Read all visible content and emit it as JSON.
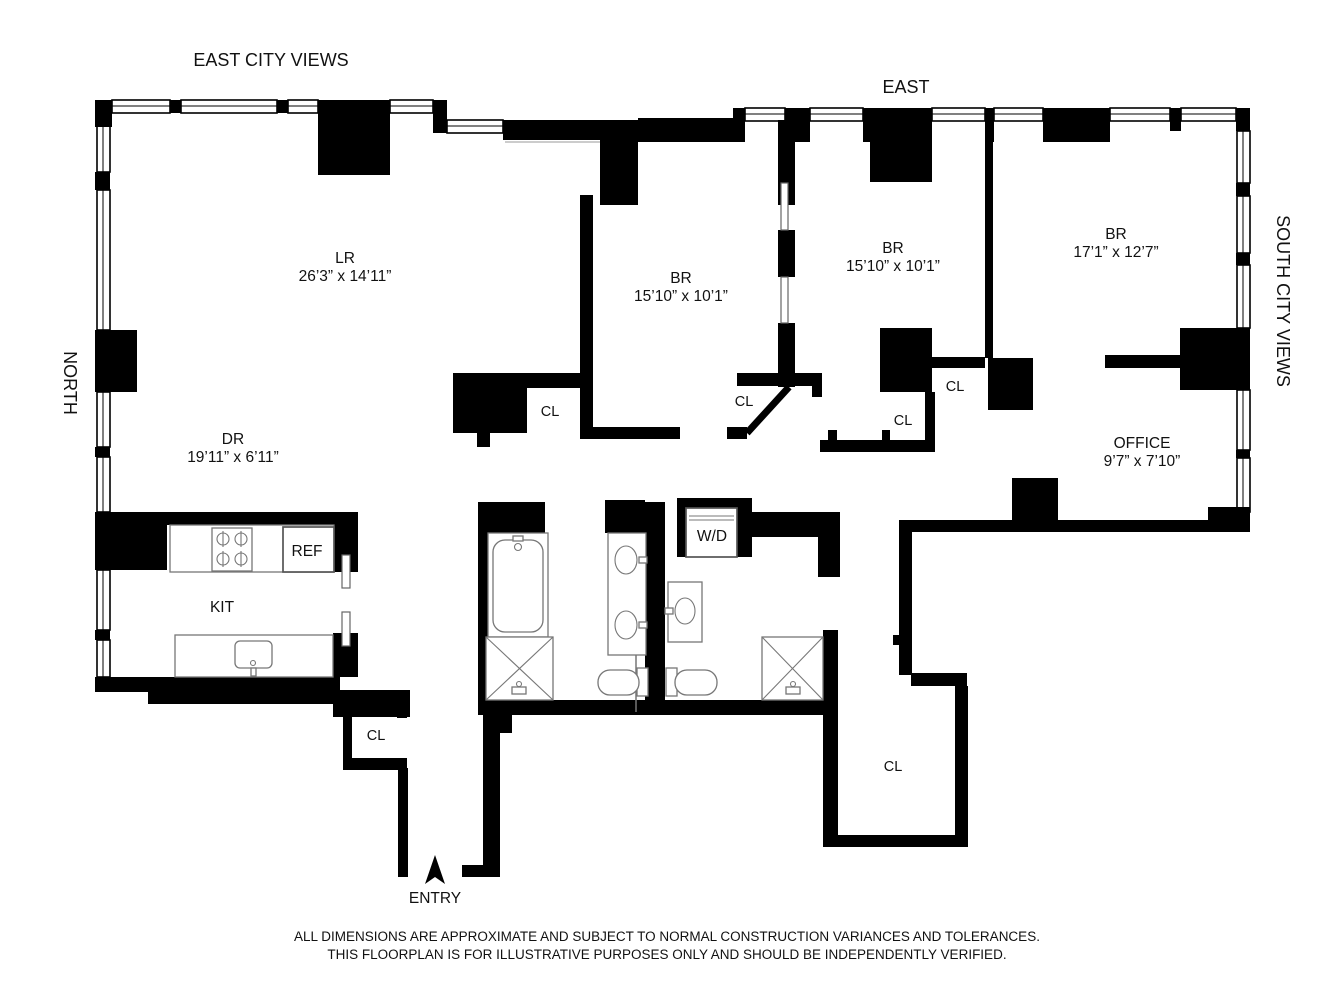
{
  "orientation_labels": {
    "top_left": "EAST CITY VIEWS",
    "top_right": "EAST",
    "left": "NORTH",
    "right": "SOUTH CITY VIEWS"
  },
  "rooms": {
    "living_room": {
      "abbr": "LR",
      "dims": "26’3” x 14’11”"
    },
    "dining_room": {
      "abbr": "DR",
      "dims": "19’11” x 6’11”"
    },
    "bedroom_center": {
      "abbr": "BR",
      "dims": "15’10” x 10’1”"
    },
    "bedroom_east": {
      "abbr": "BR",
      "dims": "15’10” x 10’1”"
    },
    "bedroom_south": {
      "abbr": "BR",
      "dims": "17’1” x 12’7”"
    },
    "office": {
      "abbr": "OFFICE",
      "dims": "9’7” x 7’10”"
    },
    "kitchen": {
      "abbr": "KIT"
    }
  },
  "fixtures": {
    "refrigerator": "REF",
    "washer_dryer": "W/D"
  },
  "closet_label": "CL",
  "entry": {
    "label": "ENTRY"
  },
  "disclaimer": {
    "line1": "ALL DIMENSIONS ARE APPROXIMATE AND SUBJECT TO NORMAL CONSTRUCTION VARIANCES AND TOLERANCES.",
    "line2": "THIS FLOORPLAN IS FOR ILLUSTRATIVE PURPOSES ONLY AND SHOULD BE INDEPENDENTLY VERIFIED."
  },
  "colors": {
    "walls": "#000000",
    "background": "#ffffff",
    "fixtures": "#777777",
    "text": "#111111"
  }
}
